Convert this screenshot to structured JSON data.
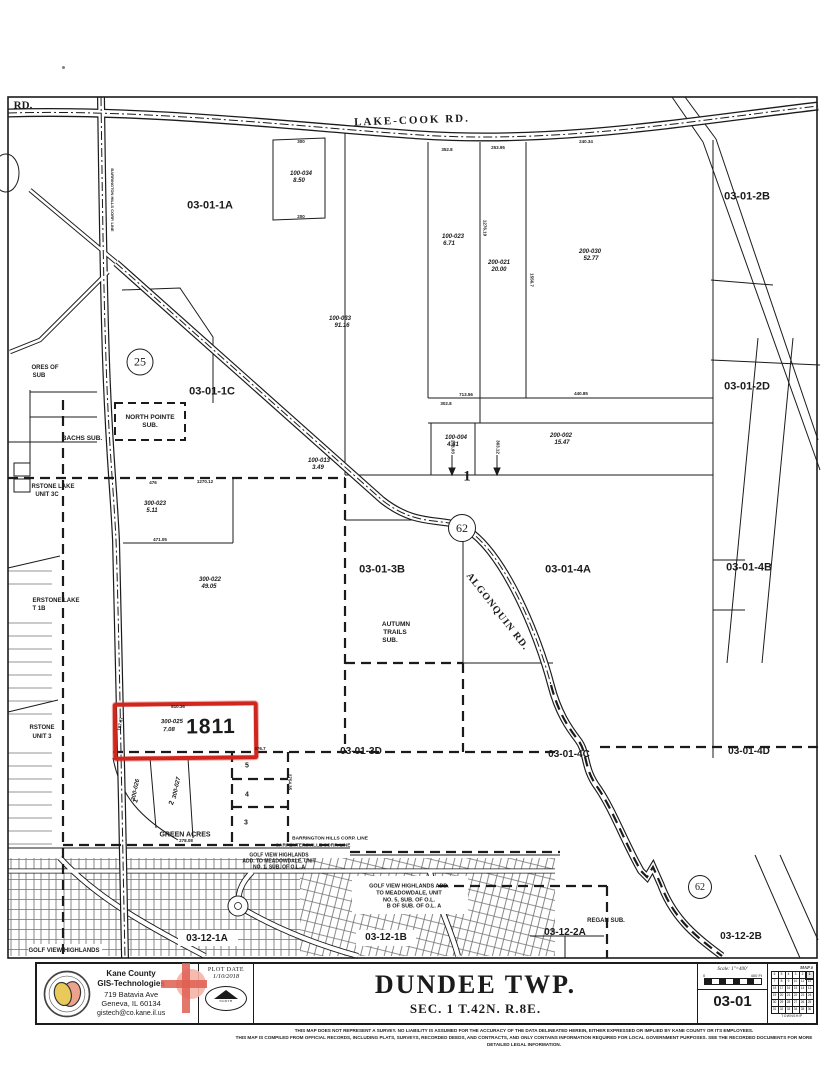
{
  "colors": {
    "ink": "#1b1b1b",
    "highlight_red": "#cf271d",
    "paper": "#ffffff",
    "logo_gold": "#e9c959",
    "logo_salmon": "#eda28e",
    "cross_pink": "#f5b3a8",
    "cross_red": "#de5f52"
  },
  "map": {
    "highlighted_parcel": {
      "number": "1811",
      "parcel_id": "300-025",
      "acreage": "7.08"
    },
    "route_markers": [
      {
        "number": "25",
        "x": 140,
        "y": 362,
        "r": 12.5
      },
      {
        "number": "62",
        "x": 462,
        "y": 528,
        "r": 13
      },
      {
        "number": "62",
        "x": 700,
        "y": 887,
        "r": 11
      }
    ],
    "labels": [
      {
        "id": "section-03-01-1A",
        "t": "03-01-1A",
        "x": 210,
        "y": 206,
        "s": 11
      },
      {
        "id": "section-03-01-2B",
        "t": "03-01-2B",
        "x": 747,
        "y": 197,
        "s": 11
      },
      {
        "id": "section-03-01-1C",
        "t": "03-01-1C",
        "x": 212,
        "y": 392,
        "s": 11
      },
      {
        "id": "section-03-01-2D",
        "t": "03-01-2D",
        "x": 747,
        "y": 387,
        "s": 11
      },
      {
        "id": "section-03-01-3B",
        "t": "03-01-3B",
        "x": 382,
        "y": 570,
        "s": 11
      },
      {
        "id": "section-03-01-4A",
        "t": "03-01-4A",
        "x": 568,
        "y": 570,
        "s": 11
      },
      {
        "id": "section-03-01-4B",
        "t": "03-01-4B",
        "x": 749,
        "y": 568,
        "s": 11
      },
      {
        "id": "section-03-01-3D",
        "t": "03-01-3D",
        "x": 361,
        "y": 752,
        "s": 10
      },
      {
        "id": "section-03-01-4C",
        "t": "03-01-4C",
        "x": 569,
        "y": 755,
        "s": 10
      },
      {
        "id": "section-03-01-4D",
        "t": "03-01-4D",
        "x": 749,
        "y": 752,
        "s": 10
      },
      {
        "id": "section-03-12-1A",
        "t": "03-12-1A",
        "x": 207,
        "y": 939,
        "s": 10
      },
      {
        "id": "section-03-12-1B",
        "t": "03-12-1B",
        "x": 386,
        "y": 938,
        "s": 10
      },
      {
        "id": "section-03-12-2A",
        "t": "03-12-2A",
        "x": 565,
        "y": 933,
        "s": 10
      },
      {
        "id": "section-03-12-2B",
        "t": "03-12-2B",
        "x": 741,
        "y": 937,
        "s": 10
      },
      {
        "id": "road-label-rd",
        "t": "RD.",
        "x": 23,
        "y": 106,
        "s": 11,
        "serif": true
      },
      {
        "id": "road-label-lake-cook",
        "t": "LAKE-COOK RD.",
        "x": 412,
        "y": 121,
        "s": 11,
        "serif": true,
        "ls": 2,
        "r": -2
      },
      {
        "id": "road-label-algonquin",
        "t": "ALGONQUIN RD.",
        "x": 497,
        "y": 612,
        "s": 10,
        "serif": true,
        "ls": 1,
        "r": 52
      },
      {
        "id": "corp-line-vertical-label",
        "t": "BARRINGTON HILLS CORP. LINE",
        "x": 112,
        "y": 200,
        "s": 4,
        "r": 90
      },
      {
        "id": "sub-north-pointe-1",
        "t": "NORTH POINTE",
        "x": 150,
        "y": 418,
        "s": 6.5
      },
      {
        "id": "sub-north-pointe-2",
        "t": "SUB.",
        "x": 150,
        "y": 426,
        "s": 6.5
      },
      {
        "id": "sub-bachs",
        "t": "BACHS SUB.",
        "x": 82,
        "y": 439,
        "s": 6.5
      },
      {
        "id": "sub-autumn-trails-1",
        "t": "AUTUMN",
        "x": 396,
        "y": 625,
        "s": 6.5
      },
      {
        "id": "sub-autumn-trails-2",
        "t": "TRAILS",
        "x": 395,
        "y": 633,
        "s": 6.5
      },
      {
        "id": "sub-autumn-trails-3",
        "t": "SUB.",
        "x": 390,
        "y": 641,
        "s": 6.5
      },
      {
        "id": "sub-green-acres",
        "t": "GREEN ACRES",
        "x": 185,
        "y": 835,
        "s": 7
      },
      {
        "id": "sub-regan",
        "t": "REGAN SUB.",
        "x": 606,
        "y": 921,
        "s": 6
      },
      {
        "id": "sub-golf-view-1",
        "t": "GOLF VIEW HIGHLANDS ADD.",
        "x": 409,
        "y": 887,
        "s": 5.5
      },
      {
        "id": "sub-golf-view-2",
        "t": "TO MEADOWDALE, UNIT",
        "x": 409,
        "y": 894,
        "s": 5.5
      },
      {
        "id": "sub-golf-view-3",
        "t": "NO. 5, SUB. OF O.L.",
        "x": 409,
        "y": 900.5,
        "s": 5.5
      },
      {
        "id": "sub-golf-view-4",
        "t": "B OF SUB. OF O.L. A",
        "x": 414,
        "y": 907,
        "s": 5.5
      },
      {
        "id": "corp-line-barrington",
        "t": "BARRINGTON HILLS CORP. LINE",
        "x": 330,
        "y": 840,
        "s": 4.8
      },
      {
        "id": "corp-line-carpentersville",
        "t": "CARPENTERSVILLE CORP. LINE",
        "x": 313,
        "y": 847,
        "s": 4.8
      },
      {
        "id": "sub-meadowdale-1",
        "t": "GOLF VIEW HIGHLANDS",
        "x": 279,
        "y": 856,
        "s": 5
      },
      {
        "id": "sub-meadowdale-2",
        "t": "ADD. TO MEADOWDALE, UNIT",
        "x": 279,
        "y": 862,
        "s": 5
      },
      {
        "id": "sub-meadowdale-3",
        "t": "NO. 1, SUB. OF O.L. A",
        "x": 279,
        "y": 868,
        "s": 5
      },
      {
        "id": "sub-golfview-left",
        "t": "GOLF VIEW HIGHLANDS",
        "x": 64,
        "y": 951,
        "s": 6
      },
      {
        "id": "sub-ores-1",
        "t": "ORES OF",
        "x": 45,
        "y": 368,
        "s": 6
      },
      {
        "id": "sub-ores-2",
        "t": "SUB",
        "x": 39,
        "y": 376,
        "s": 6
      },
      {
        "id": "sub-waterstone-3c-1",
        "t": "RSTONE LAKE",
        "x": 53,
        "y": 487,
        "s": 6
      },
      {
        "id": "sub-waterstone-3c-2",
        "t": "UNIT 3C",
        "x": 47,
        "y": 495,
        "s": 6
      },
      {
        "id": "sub-waterstone-1b-1",
        "t": "ERSTONE LAKE",
        "x": 56,
        "y": 601,
        "s": 6
      },
      {
        "id": "sub-waterstone-1b-2",
        "t": "T 1B",
        "x": 39,
        "y": 609,
        "s": 6
      },
      {
        "id": "sub-waterstone-3-1",
        "t": "RSTONE",
        "x": 42,
        "y": 728,
        "s": 6
      },
      {
        "id": "sub-waterstone-3-2",
        "t": "UNIT 3",
        "x": 42,
        "y": 737,
        "s": 6
      },
      {
        "id": "parcel-100-034",
        "t": "100-034",
        "x": 301,
        "y": 174,
        "s": 6,
        "it": true
      },
      {
        "id": "parcel-100-034-ac",
        "t": "8.50",
        "x": 299,
        "y": 181,
        "s": 6,
        "it": true
      },
      {
        "id": "parcel-100-033",
        "t": "100-033",
        "x": 340,
        "y": 319,
        "s": 6,
        "it": true
      },
      {
        "id": "parcel-100-033-ac",
        "t": "91.16",
        "x": 342,
        "y": 326,
        "s": 6,
        "it": true
      },
      {
        "id": "parcel-100-023",
        "t": "100-023",
        "x": 453,
        "y": 237,
        "s": 6,
        "it": true
      },
      {
        "id": "parcel-100-023-ac",
        "t": "6.71",
        "x": 449,
        "y": 244,
        "s": 6,
        "it": true
      },
      {
        "id": "parcel-200-021",
        "t": "200-021",
        "x": 499,
        "y": 263,
        "s": 6,
        "it": true
      },
      {
        "id": "parcel-200-021-ac",
        "t": "20.00",
        "x": 499,
        "y": 270,
        "s": 6,
        "it": true
      },
      {
        "id": "parcel-200-030",
        "t": "200-030",
        "x": 590,
        "y": 252,
        "s": 6,
        "it": true
      },
      {
        "id": "parcel-200-030-ac",
        "t": "52.77",
        "x": 591,
        "y": 259,
        "s": 6,
        "it": true
      },
      {
        "id": "parcel-100-013",
        "t": "100-013",
        "x": 319,
        "y": 461,
        "s": 6,
        "it": true
      },
      {
        "id": "parcel-100-013-ac",
        "t": "3.49",
        "x": 318,
        "y": 468,
        "s": 6,
        "it": true
      },
      {
        "id": "parcel-100-004",
        "t": "100-004",
        "x": 456,
        "y": 438,
        "s": 6,
        "it": true
      },
      {
        "id": "parcel-100-004-ac",
        "t": "4.31",
        "x": 453,
        "y": 445,
        "s": 6,
        "it": true
      },
      {
        "id": "parcel-200-002",
        "t": "200-002",
        "x": 561,
        "y": 436,
        "s": 6,
        "it": true
      },
      {
        "id": "parcel-200-002-ac",
        "t": "15.47",
        "x": 562,
        "y": 443,
        "s": 6,
        "it": true
      },
      {
        "id": "parcel-300-023",
        "t": "300-023",
        "x": 155,
        "y": 504,
        "s": 6,
        "it": true
      },
      {
        "id": "parcel-300-023-ac",
        "t": "5.11",
        "x": 152,
        "y": 511,
        "s": 6,
        "it": true
      },
      {
        "id": "parcel-300-022",
        "t": "300-022",
        "x": 210,
        "y": 580,
        "s": 6,
        "it": true
      },
      {
        "id": "parcel-300-022-ac",
        "t": "49.05",
        "x": 209,
        "y": 587,
        "s": 6,
        "it": true
      },
      {
        "id": "parcel-300-026",
        "t": "300-026",
        "x": 136,
        "y": 790,
        "s": 6,
        "it": true,
        "r": -78
      },
      {
        "id": "parcel-300-027",
        "t": "300-027",
        "x": 177,
        "y": 788,
        "s": 6,
        "it": true,
        "r": -78
      },
      {
        "id": "lot-5",
        "t": "5",
        "x": 247,
        "y": 766,
        "s": 7
      },
      {
        "id": "lot-4",
        "t": "4",
        "x": 247,
        "y": 795,
        "s": 7
      },
      {
        "id": "lot-3",
        "t": "3",
        "x": 246,
        "y": 823,
        "s": 7
      },
      {
        "id": "lot-1",
        "t": "1",
        "x": 136,
        "y": 801,
        "s": 7,
        "r": -70
      },
      {
        "id": "lot-2",
        "t": "2",
        "x": 172,
        "y": 803,
        "s": 7,
        "r": -70
      },
      {
        "id": "quarter-marker-1",
        "t": "1",
        "x": 467,
        "y": 477,
        "s": 15,
        "serif": true
      },
      {
        "id": "dim-300",
        "t": "300",
        "x": 301,
        "y": 142,
        "s": 4.5
      },
      {
        "id": "dim-200",
        "t": "200",
        "x": 301,
        "y": 217,
        "s": 4.5
      },
      {
        "id": "dim-352-8",
        "t": "352.8",
        "x": 447,
        "y": 150,
        "s": 4.5
      },
      {
        "id": "dim-253-95",
        "t": "253.95",
        "x": 498,
        "y": 148,
        "s": 4.5
      },
      {
        "id": "dim-240-34",
        "t": "240.34",
        "x": 586,
        "y": 142,
        "s": 4.5
      },
      {
        "id": "dim-1276-19",
        "t": "1276.19",
        "x": 484,
        "y": 228,
        "s": 4.5,
        "r": 90
      },
      {
        "id": "dim-1556-7",
        "t": "1556.7",
        "x": 531,
        "y": 280,
        "s": 4.5,
        "r": 90
      },
      {
        "id": "dim-713-56",
        "t": "713.56",
        "x": 466,
        "y": 395,
        "s": 4.5
      },
      {
        "id": "dim-440-85",
        "t": "440.85",
        "x": 581,
        "y": 394,
        "s": 4.5
      },
      {
        "id": "dim-302-8",
        "t": "302.8",
        "x": 446,
        "y": 404,
        "s": 4.5
      },
      {
        "id": "dim-1270-12",
        "t": "1270.12",
        "x": 205,
        "y": 482,
        "s": 4.5
      },
      {
        "id": "dim-476",
        "t": "476",
        "x": 153,
        "y": 483,
        "s": 4.5
      },
      {
        "id": "dim-471-05",
        "t": "471.05",
        "x": 160,
        "y": 540,
        "s": 4.5
      },
      {
        "id": "dim-203-93",
        "t": "203.93",
        "x": 452,
        "y": 447,
        "s": 4.5,
        "r": 90
      },
      {
        "id": "dim-363-12",
        "t": "363.12",
        "x": 497,
        "y": 447,
        "s": 4.5,
        "r": 90
      },
      {
        "id": "dim-810-36",
        "t": "810.36",
        "x": 178,
        "y": 707,
        "s": 4.5
      },
      {
        "id": "dim-187-37",
        "t": "187.37",
        "x": 121,
        "y": 724,
        "s": 4.5,
        "r": -80
      },
      {
        "id": "dim-376-7",
        "t": "376.7",
        "x": 260,
        "y": 749,
        "s": 4.5
      },
      {
        "id": "dim-278-08",
        "t": "278.08",
        "x": 186,
        "y": 841,
        "s": 4.5
      },
      {
        "id": "dim-2754-35",
        "t": "2754.35",
        "x": 289,
        "y": 782,
        "s": 4.5,
        "r": 90
      }
    ]
  },
  "title_block": {
    "agency_line1": "Kane County",
    "agency_line2": "GIS-Technologies",
    "address_line1": "719 Batavia Ave",
    "address_line2": "Geneva, IL 60134",
    "email": "gistech@co.kane.il.us",
    "plot_date_label": "PLOT DATE",
    "plot_date": "1/10/2018",
    "north_label": "NORTH",
    "township_title": "DUNDEE TWP.",
    "section_subtitle": "SEC. 1 T.42N. R.8E.",
    "scale_label": "Scale: 1\"=400'",
    "scale_zero": "0",
    "scale_max": "400 Ft",
    "sheet_number": "03-01",
    "map_grid_title": "MAP #",
    "map_grid_footer": "TOWNSHIP",
    "township_grid": {
      "highlighted": "1",
      "rows": [
        [
          6,
          5,
          4,
          3,
          2,
          1
        ],
        [
          7,
          8,
          9,
          10,
          11,
          12
        ],
        [
          18,
          17,
          16,
          15,
          14,
          13
        ],
        [
          19,
          20,
          21,
          22,
          23,
          24
        ],
        [
          30,
          29,
          28,
          27,
          26,
          25
        ],
        [
          31,
          32,
          33,
          34,
          35,
          36
        ]
      ]
    }
  },
  "disclaimer": {
    "line1": "THIS MAP DOES NOT REPRESENT A SURVEY. NO LIABILITY IS ASSUMED FOR THE ACCURACY OF THE DATA DELINEATED HEREIN, EITHER EXPRESSED OR IMPLIED BY KANE COUNTY OR ITS EMPLOYEES.",
    "line2": "THIS MAP IS COMPILED FROM OFFICIAL RECORDS, INCLUDING PLATS, SURVEYS, RECORDED DEEDS, AND CONTRACTS, AND ONLY CONTAINS INFORMATION REQUIRED FOR LOCAL GOVERNMENT PURPOSES. SEE THE RECORDED DOCUMENTS FOR MORE DETAILED LEGAL INFORMATION."
  }
}
